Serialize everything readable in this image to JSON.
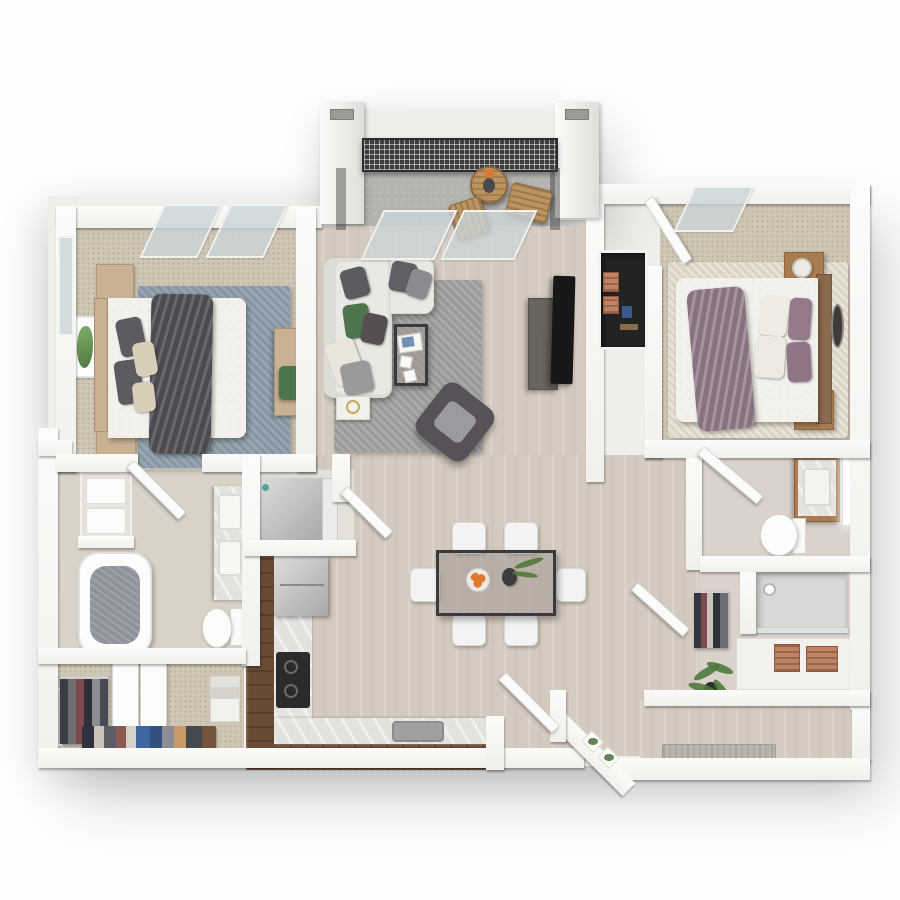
{
  "palette": {
    "canvas": "#fdfdfd",
    "wall": "#f8f8f6",
    "wood_floor": "#d5cabf",
    "carpet": "#cfc6b5",
    "concrete": "#b4b3b0",
    "tile_bath": "#d9d2c7",
    "tile_bath2": "#dbd2cb",
    "rug_blue": "#8fa0ab",
    "rug_gray": "#a3a3a0",
    "rug_cream": "#e8e1d2",
    "bedding_white": "#f2f1ec",
    "throw_gray": "#5a575c",
    "throw_mauve": "#9d8692",
    "pillow_dark": "#5d5a60",
    "pillow_beige": "#d8cdb8",
    "pillow_green": "#4e7450",
    "pillow_mauve": "#93798a",
    "sofa": "#e9e8e4",
    "accent_chair": "#57525a",
    "accent_cushion": "#9c9aa0",
    "wood_light": "#c9b193",
    "wood_warm": "#a87c50",
    "wood_dark_cab": "#6b4a33",
    "headboard2": "#8a6a4e",
    "marble": "#e4e2df",
    "cooktop": "#2b2b2d",
    "sink_steel": "#9fa19f",
    "table_frame": "#3a3a3c",
    "glass_top": "rgba(160,152,144,0.55)",
    "chair_white": "#f4f3f1",
    "tv": "#17171a",
    "console": "#6a645e",
    "railing": "#3c3c3c",
    "patio_wood": "#bd9360",
    "orange": "#dd7a2b",
    "plant": "#4e7a3c",
    "water": "#8e929a",
    "mat": "#b9b5ad",
    "glass_pane": "rgba(203,213,216,0.8)",
    "niche_dark": "#232324",
    "crate": "#c08262",
    "art_green": "#7fae6a"
  },
  "floorplan": {
    "title": "3D rendered floor plan — 2 bedroom / 2 bathroom apartment with balcony",
    "rooms": [
      {
        "label": "Balcony",
        "items": [
          "mesh railing",
          "round bistro table",
          "two wood chairs",
          "sliding glass doors"
        ]
      },
      {
        "label": "Living room",
        "items": [
          "sectional sofa",
          "coffee table",
          "accent chair",
          "TV console",
          "gray rug"
        ]
      },
      {
        "label": "Dining area",
        "items": [
          "glass dining table",
          "six white chairs",
          "bowl of oranges",
          "vase with greenery"
        ]
      },
      {
        "label": "Kitchen",
        "items": [
          "refrigerator",
          "cooktop",
          "sink",
          "L-shaped counter"
        ]
      },
      {
        "label": "Bedroom 1",
        "items": [
          "bed with gray throw",
          "two nightstands",
          "desk with green chair",
          "blue-gray rug",
          "botanical wall art"
        ]
      },
      {
        "label": "Bathroom 1",
        "items": [
          "bathtub",
          "double vanity",
          "toilet",
          "linen shelves with towels"
        ]
      },
      {
        "label": "Walk-in closet 1",
        "items": [
          "hanging clothes",
          "double doors",
          "shoe shelf",
          "mirror panel"
        ]
      },
      {
        "label": "Bedroom 2",
        "items": [
          "bed with mauve throw",
          "two nightstands with lamps",
          "wall mirror",
          "cream rug"
        ]
      },
      {
        "label": "Bathroom 2",
        "items": [
          "vanity with lit mirror",
          "toilet",
          "walk-in shower"
        ]
      },
      {
        "label": "Walk-in closet 2",
        "items": [
          "hanging clothes",
          "storage crates"
        ]
      },
      {
        "label": "Entry",
        "items": [
          "entry door",
          "door mat",
          "potted plant",
          "plant shelf"
        ]
      },
      {
        "label": "Laundry closet",
        "items": [
          "washer",
          "angled door"
        ]
      }
    ]
  }
}
